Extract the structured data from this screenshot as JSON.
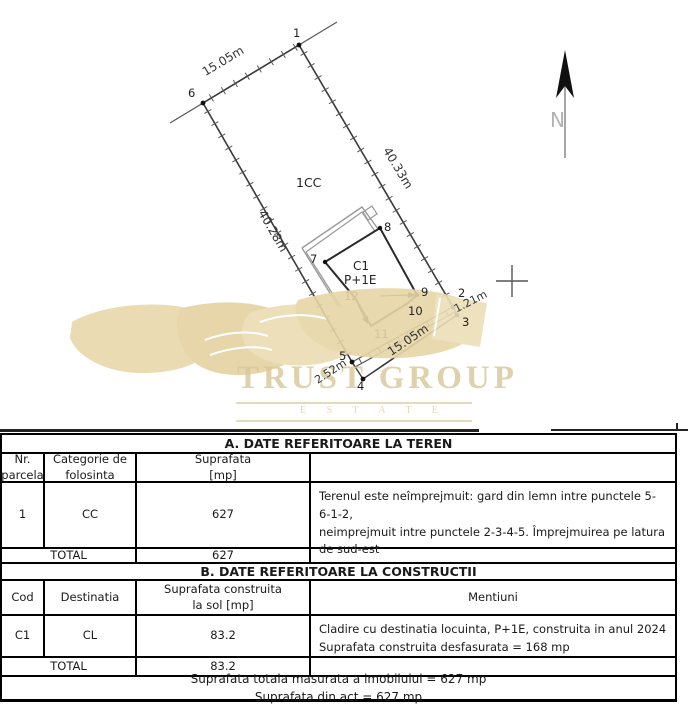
{
  "plan": {
    "region_label": "1CC",
    "north_label": "N",
    "building": {
      "code": "C1",
      "regime": "P+1E"
    },
    "point_labels": {
      "p1": "1",
      "p2": "2",
      "p3": "3",
      "p4": "4",
      "p5": "5",
      "p6": "6",
      "p7": "7",
      "p8": "8",
      "p9": "9",
      "p10": "10",
      "p11": "11",
      "p12": "12"
    },
    "dimensions": {
      "top": "15.05m",
      "right": "40.33m",
      "left": "40.28m",
      "bottom": "15.05m",
      "side_2_3": "1.21m",
      "side_4_5": "2.52m"
    }
  },
  "watermark": {
    "brand": "TRUST GROUP",
    "subtitle": "E S T A T E"
  },
  "section_a": {
    "title": "A. DATE REFERITOARE LA TEREN",
    "headers": {
      "col1": "Nr.\nparcela",
      "col2": "Categorie de\nfolosinta",
      "col3": "Suprafata\n[mp]",
      "col4": ""
    },
    "row": {
      "nr": "1",
      "categorie": "CC",
      "suprafata": "627",
      "mentiuni": "Terenul este neîmprejmuit: gard din lemn intre punctele 5-6-1-2,\nneimprejmuit intre punctele 2-3-4-5. Împrejmuirea pe latura de sud-est"
    },
    "total_label": "TOTAL",
    "total_value": "627"
  },
  "section_b": {
    "title": "B. DATE REFERITOARE LA CONSTRUCTII",
    "headers": {
      "col1": "Cod",
      "col2": "Destinatia",
      "col3": "Suprafata construita\nla sol [mp]",
      "col4": "Mentiuni"
    },
    "row": {
      "cod": "C1",
      "destinatia": "CL",
      "suprafata": "83.2",
      "mentiuni": "Cladire cu destinatia locuinta, P+1E, construita in anul 2024\nSuprafata construita desfasurata = 168 mp"
    },
    "total_label": "TOTAL",
    "total_value": "83.2"
  },
  "footer": {
    "line1": "Suprafata totala masurata a imobilului = 627 mp",
    "line2": "Suprafata din act = 627 mp"
  }
}
